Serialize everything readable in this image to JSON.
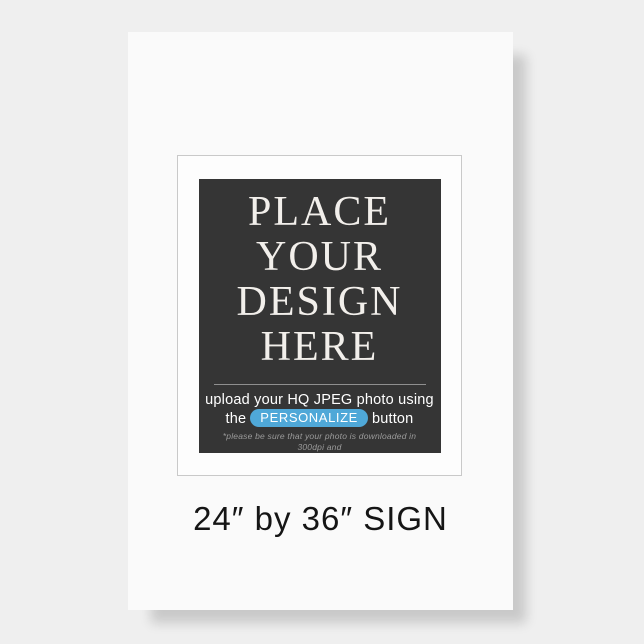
{
  "page": {
    "background_color": "#efefef",
    "description": "product mockup of a blank sign template"
  },
  "poster": {
    "size_label": "24″ by 36″ SIGN",
    "colors": {
      "sheet": "#fafafa",
      "frame_border": "#c9c9c9",
      "panel_background": "#353535",
      "headline_text": "#f2efeb",
      "personalize_pill": "#4fa8d8",
      "instruction_text": "#ffffff",
      "fine_print_text": "#9b9b9b",
      "size_label_text": "#151515"
    },
    "placeholder": {
      "headline_lines": [
        "PLACE",
        "YOUR",
        "DESIGN",
        "HERE"
      ],
      "instruction_line1": "upload your HQ JPEG photo using",
      "instruction_line2_prefix": "the",
      "personalize_button_label": "PERSONALIZE",
      "instruction_line2_suffix": "button",
      "fine_print_line1": "*please be sure that your photo is downloaded in 300dpi and",
      "fine_print_line2": "with included bleed lines"
    }
  }
}
